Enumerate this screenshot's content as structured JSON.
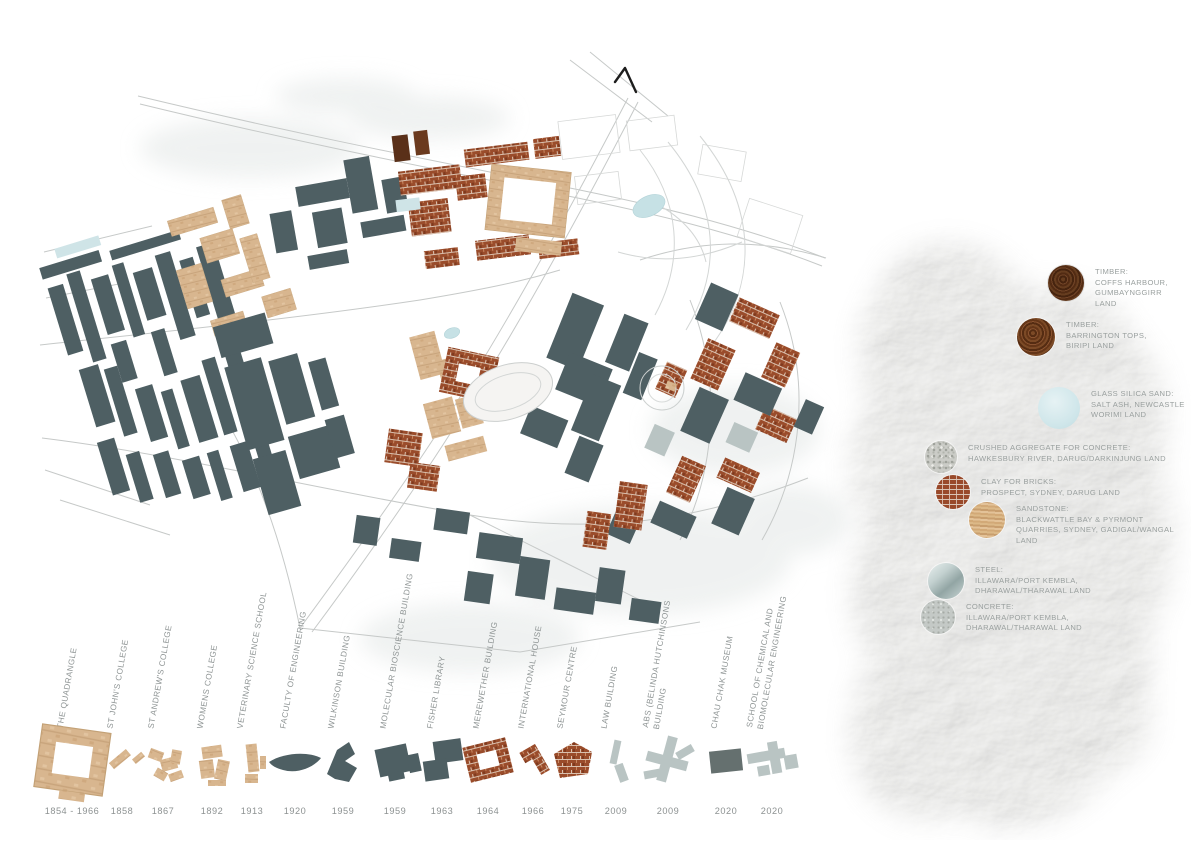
{
  "palette": {
    "slate_building": "#4e5f63",
    "sandstone_building": "#d8b68f",
    "brick_building": "#9a4c2b",
    "new_grey_building": "#b9c4c3",
    "dark_grey_building": "#65706f",
    "pond_blue": "#c6e1e5",
    "road_grey": "#c6c9c8",
    "legend_text_grey": "#9aa09f",
    "timeline_text_grey": "#8f9595"
  },
  "north_arrow": {
    "icon": "north-arrow-icon"
  },
  "materials_legend": [
    {
      "id": "timber-coffs-harbour",
      "swatch_icon": "timber-swatch-icon",
      "label": "TIMBER:\nCOFFS HARBOUR,\nGUMBAYNGGIRR\nLAND"
    },
    {
      "id": "timber-barrington-tops",
      "swatch_icon": "timber-swatch-icon",
      "label": "TIMBER:\nBARRINGTON TOPS,\nBIRIPI LAND"
    },
    {
      "id": "glass-silica-sand",
      "swatch_icon": "glass-sand-swatch-icon",
      "label": "GLASS SILICA SAND:\nSALT ASH, NEWCASTLE\nWORIMI LAND"
    },
    {
      "id": "crushed-aggregate",
      "swatch_icon": "aggregate-swatch-icon",
      "label": "CRUSHED AGGREGATE FOR CONCRETE:\nHAWKESBURY RIVER, DARUG/DARKINJUNG LAND"
    },
    {
      "id": "clay-for-bricks",
      "swatch_icon": "brick-swatch-icon",
      "label": "CLAY FOR BRICKS:\nPROSPECT, SYDNEY, DARUG LAND"
    },
    {
      "id": "sandstone",
      "swatch_icon": "sandstone-swatch-icon",
      "label": "SANDSTONE:\nBLACKWATTLE BAY & PYRMONT\nQUARRIES, SYDNEY, GADIGAL/WANGAL\nLAND"
    },
    {
      "id": "steel",
      "swatch_icon": "steel-swatch-icon",
      "label": "STEEL:\nILLAWARA/PORT KEMBLA,\nDHARAWAL/THARAWAL LAND"
    },
    {
      "id": "concrete",
      "swatch_icon": "concrete-swatch-icon",
      "label": "CONCRETE:\nILLAWARA/PORT KEMBLA,\nDHARAWAL/THARAWAL LAND"
    }
  ],
  "timeline": [
    {
      "label": "THE QUADRANGLE",
      "year": "1854 - 1966",
      "glyph": "quadrangle-footprint-icon",
      "material": "sandstone"
    },
    {
      "label": "ST JOHN'S COLLEGE",
      "year": "1858",
      "glyph": "st-johns-footprint-icon",
      "material": "sandstone"
    },
    {
      "label": "ST ANDREW'S COLLEGE",
      "year": "1867",
      "glyph": "st-andrews-footprint-icon",
      "material": "sandstone"
    },
    {
      "label": "WOMENS COLLEGE",
      "year": "1892",
      "glyph": "womens-college-footprint-icon",
      "material": "sandstone"
    },
    {
      "label": "VETERINARY SCIENCE SCHOOL",
      "year": "1913",
      "glyph": "vet-science-footprint-icon",
      "material": "sandstone"
    },
    {
      "label": "FACULTY OF ENGINEERING",
      "year": "1920",
      "glyph": "engineering-footprint-icon",
      "material": "slate"
    },
    {
      "label": "WILKINSON BUILDING",
      "year": "1959",
      "glyph": "wilkinson-footprint-icon",
      "material": "slate"
    },
    {
      "label": "MOLECULAR BIOSCIENCE BUILDING",
      "year": "1959",
      "glyph": "molecular-bioscience-footprint-icon",
      "material": "slate"
    },
    {
      "label": "FISHER LIBRARY",
      "year": "1963",
      "glyph": "fisher-library-footprint-icon",
      "material": "slate"
    },
    {
      "label": "MEREWETHER BUILDING",
      "year": "1964",
      "glyph": "merewether-footprint-icon",
      "material": "brick"
    },
    {
      "label": "INTERNATIONAL HOUSE",
      "year": "1966",
      "glyph": "international-house-footprint-icon",
      "material": "brick"
    },
    {
      "label": "SEYMOUR CENTRE",
      "year": "1975",
      "glyph": "seymour-centre-footprint-icon",
      "material": "brick"
    },
    {
      "label": "LAW BUILDING",
      "year": "2009",
      "glyph": "law-building-footprint-icon",
      "material": "new-grey"
    },
    {
      "label": "ABS (BELINDA HUTCHINSONS\nBUILDING",
      "year": "2009",
      "glyph": "abs-building-footprint-icon",
      "material": "new-grey"
    },
    {
      "label": "CHAU CHAK MUSEUM",
      "year": "2020",
      "glyph": "chau-chak-footprint-icon",
      "material": "dark-grey"
    },
    {
      "label": "SCHOOL OF CHEMICAL AND\nBIOMOLECULAR ENGINEERING",
      "year": "2020",
      "glyph": "chem-school-footprint-icon",
      "material": "new-grey"
    }
  ]
}
